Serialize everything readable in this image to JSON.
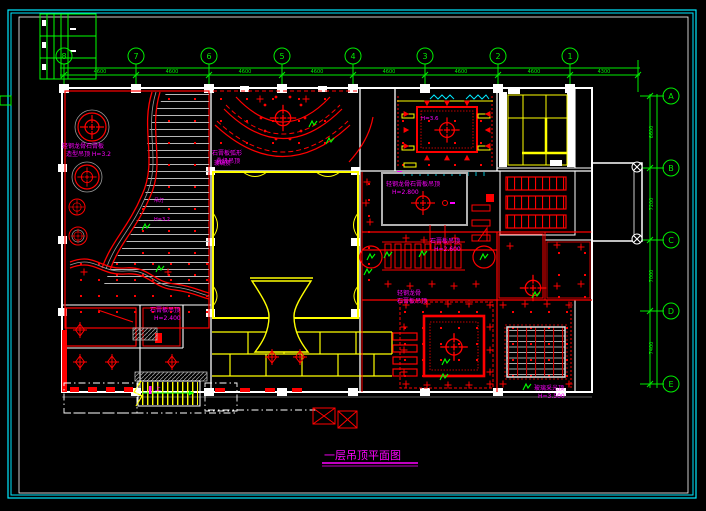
{
  "app": {
    "background": "#000000",
    "canvas_type": "cad-ceiling-plan"
  },
  "title": {
    "text": "一层吊顶平面图"
  },
  "grid": {
    "cols": [
      "8",
      "7",
      "6",
      "5",
      "4",
      "3",
      "2",
      "1"
    ],
    "rows": [
      "A",
      "B",
      "C",
      "D",
      "E"
    ],
    "top_dims": [
      "4600",
      "4600",
      "4600",
      "4600",
      "4600",
      "4600",
      "4600",
      "4300"
    ],
    "right_dims": [
      "6600",
      "7200",
      "7000",
      "7400"
    ]
  },
  "labels": [
    {
      "lines": [
        "轻钢龙骨石膏板",
        "造型吊顶 H=3.2"
      ]
    },
    {
      "lines": [
        "石膏板弧形",
        "叠级吊顶"
      ]
    },
    {
      "lines": [
        "轻钢龙骨石膏板吊顶",
        "H=2.800"
      ]
    },
    {
      "lines": [
        "石膏板吊顶",
        "H=2.600"
      ]
    },
    {
      "lines": [
        "轻钢龙骨",
        "石膏板吊顶"
      ]
    },
    {
      "lines": [
        "玻璃采光顶",
        "H=3.500"
      ]
    },
    {
      "lines": [
        "石膏板吊顶",
        "H=2.400"
      ]
    },
    {
      "lines": [
        "玻璃顶"
      ]
    },
    {
      "lines": [
        "H=3.6"
      ]
    },
    {
      "lines": [
        "上"
      ]
    },
    {
      "lines": [
        "吊灯"
      ]
    },
    {
      "lines": [
        "H=3.2"
      ]
    }
  ],
  "colors": {
    "frame": "#00e8ff",
    "grid_lines": "#00ec00",
    "walls": "#ffffff",
    "partitions": "#ff0000",
    "ceiling_features": "#ffff00",
    "annotations": "#ff00ff",
    "slats": "#b8b8b8"
  }
}
